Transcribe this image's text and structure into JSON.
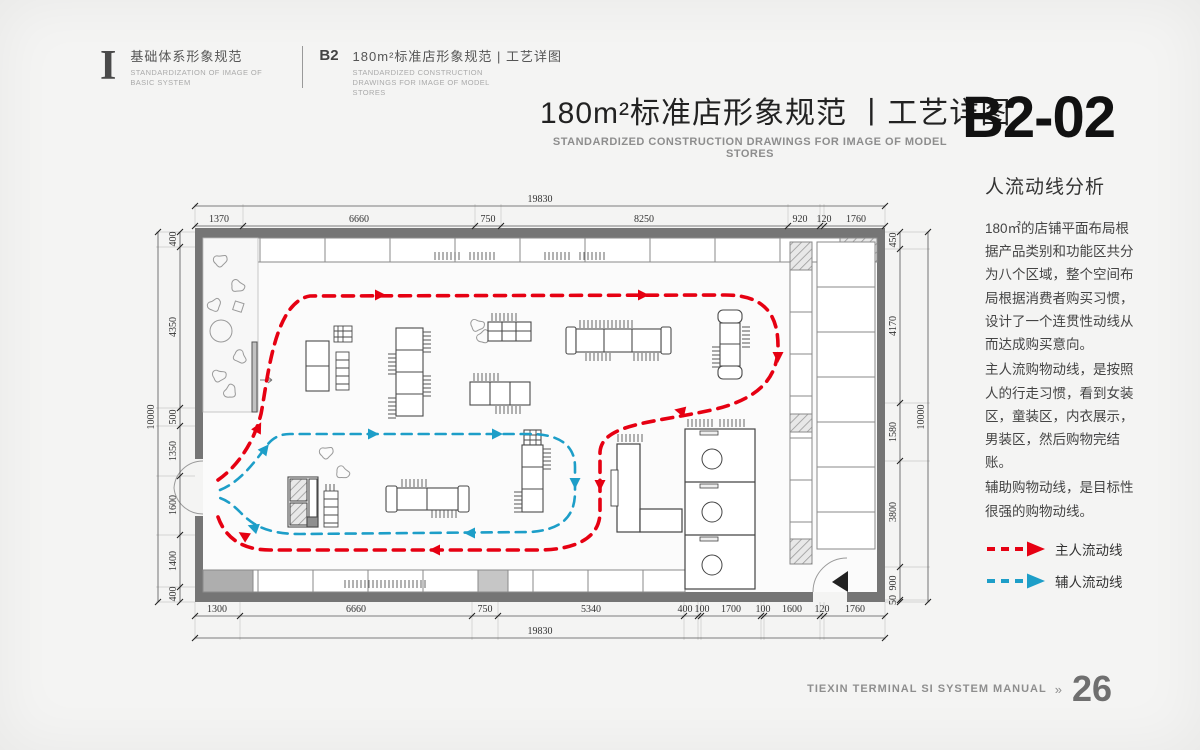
{
  "header": {
    "logo": "I",
    "series_title": "基础体系形象规范",
    "series_subtitle_en": "STANDARDIZATION OF IMAGE OF BASIC SYSTEM",
    "section_code": "B2",
    "section_title": "180m²标准店形象规范 | 工艺详图",
    "section_subtitle_en": "STANDARDIZED CONSTRUCTION DRAWINGS FOR IMAGE OF MODEL STORES"
  },
  "title_block": {
    "title": "180m²标准店形象规范 丨工艺详图",
    "subtitle_en": "STANDARDIZED CONSTRUCTION DRAWINGS FOR IMAGE OF MODEL STORES",
    "page_code": "B2-02"
  },
  "sidebar": {
    "heading": "人流动线分析",
    "paragraphs": [
      "180㎡的店铺平面布局根据产品类别和功能区共分为八个区域，整个空间布局根据消费者购买习惯，设计了一个连贯性动线从而达成购买意向。",
      "主人流购物动线，是按照人的行走习惯，看到女装区，童装区，内衣展示，男装区，然后购物完结账。",
      "辅助购物动线，是目标性很强的购物动线。"
    ],
    "legend": [
      {
        "label": "主人流动线",
        "color": "#e60012"
      },
      {
        "label": "辅人流动线",
        "color": "#1d9ec8"
      }
    ]
  },
  "plan": {
    "dims": {
      "top_overall": "19830",
      "top": [
        "1370",
        "6660",
        "750",
        "8250",
        "920",
        "120",
        "1760"
      ],
      "bottom": [
        "1300",
        "6660",
        "750",
        "5340",
        "400",
        "100",
        "1700",
        "100",
        "1600",
        "120",
        "1760"
      ],
      "bottom_overall": "19830",
      "left": [
        "400",
        "4350",
        "500",
        "1350",
        "1600",
        "1400",
        "400"
      ],
      "left_overall": "10000",
      "right": [
        "450",
        "4170",
        "1580",
        "3800",
        "900",
        "50"
      ],
      "right_overall": "10000"
    }
  },
  "footer": {
    "manual_title": "TIEXIN TERMINAL SI SYSTEM MANUAL",
    "separator": "»",
    "page_number": "26"
  },
  "colors": {
    "main_flow": "#e60012",
    "aux_flow": "#1d9ec8",
    "wall": "#757575"
  }
}
